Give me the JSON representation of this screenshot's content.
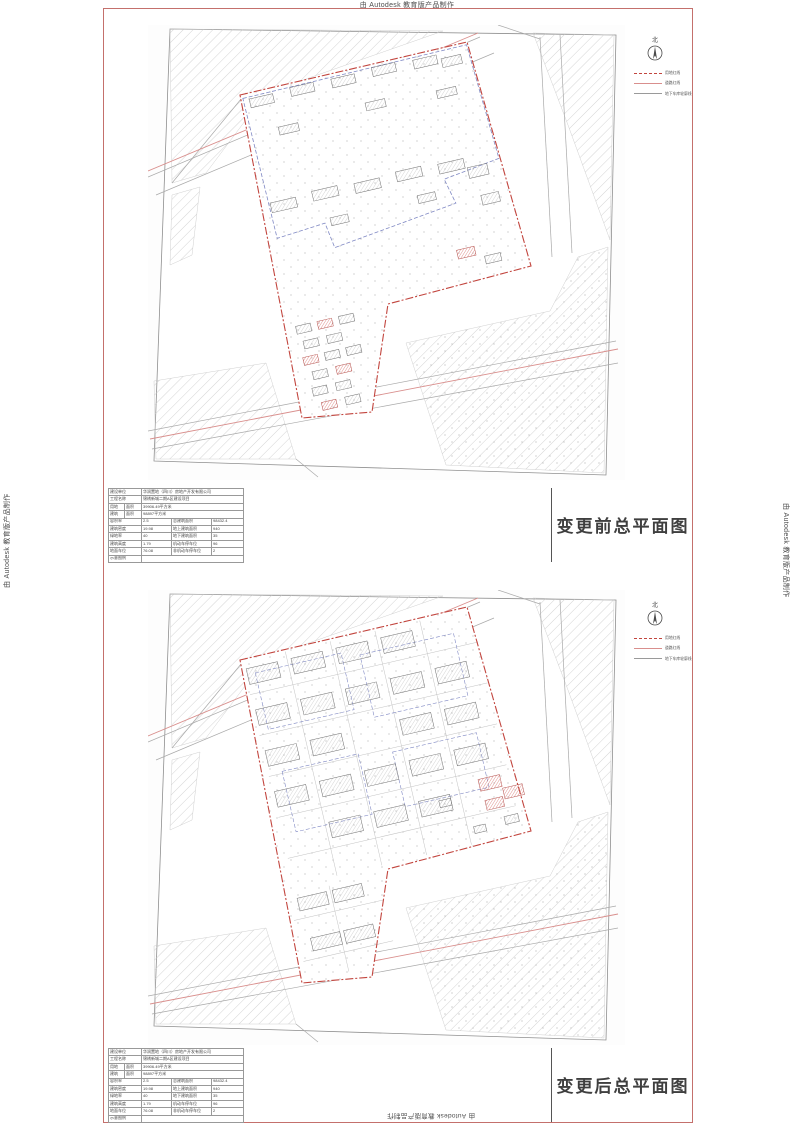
{
  "page": {
    "border_color": "#c4706c",
    "site_line_color": "#c2453e",
    "road_redline_color": "#d98f8d",
    "garage_line_color": "#8089c4"
  },
  "watermark": {
    "text": "由 Autodesk 教育版产品制作"
  },
  "compass": {
    "north_label": "北"
  },
  "legend": {
    "items": [
      {
        "label": "用地红线",
        "style": "dashed-red"
      },
      {
        "label": "道路红线",
        "style": "solid-red"
      },
      {
        "label": "地下车库轮廓线",
        "style": "solid-gray"
      }
    ]
  },
  "sheets": [
    {
      "title": "变更前总平面图"
    },
    {
      "title": "变更后总平面图"
    }
  ],
  "titleblock": {
    "rows": [
      [
        [
          "建设单位",
          2
        ],
        [
          "华润置地（四川）房地产开发有限公司",
          3
        ]
      ],
      [
        [
          "工程名称",
          2
        ],
        [
          "锦绣新城二期A区建设项目",
          3
        ]
      ],
      [
        [
          "用地",
          1
        ],
        [
          "面积",
          1
        ],
        [
          "39906.49平方米",
          3
        ]
      ],
      [
        [
          "建筑",
          1
        ],
        [
          "面积",
          1
        ],
        [
          "98897平方米",
          3
        ]
      ],
      [
        [
          "容积率",
          2
        ],
        [
          "2.5",
          1
        ],
        [
          "总建筑面积",
          1
        ],
        [
          "98432.4",
          1
        ]
      ],
      [
        [
          "建筑密度",
          2
        ],
        [
          "19.98",
          1
        ],
        [
          "地上建筑面积",
          1
        ],
        [
          "940",
          1
        ]
      ],
      [
        [
          "绿地率",
          2
        ],
        [
          "40",
          1
        ],
        [
          "地下建筑面积",
          1
        ],
        [
          "35",
          1
        ]
      ],
      [
        [
          "建筑高度",
          2
        ],
        [
          "1.79",
          1
        ],
        [
          "机动车停车位",
          1
        ],
        [
          "96",
          1
        ]
      ],
      [
        [
          "地面车位",
          2
        ],
        [
          "76.08",
          1
        ],
        [
          "非机动车停车位",
          1
        ],
        [
          "2",
          1
        ]
      ],
      [
        [
          "示意图例",
          2
        ],
        [
          "",
          3
        ]
      ]
    ]
  }
}
